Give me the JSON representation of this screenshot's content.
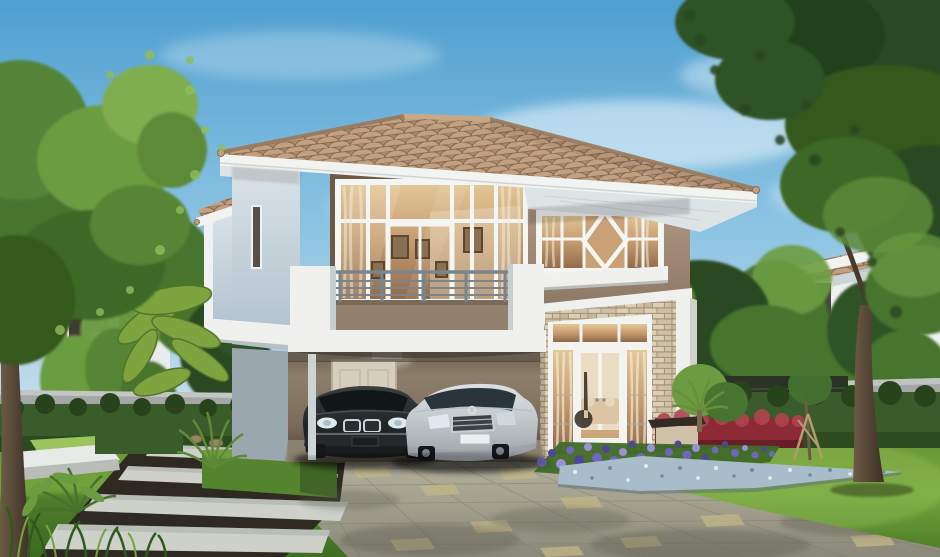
{
  "image": {
    "width": 940,
    "height": 557
  },
  "scene": {
    "title": "Exterior rendering of a two-storey detached house with carport, two sedans, front lawn and garden",
    "elements": [
      {
        "name": "sky",
        "label": "clear blue sky with wispy clouds"
      },
      {
        "name": "neighbor-house-left",
        "label": "neighbouring house behind trees, left"
      },
      {
        "name": "neighbor-house-right",
        "label": "neighbouring house behind trees, right"
      },
      {
        "name": "perimeter-wall",
        "label": "grey concrete garden wall"
      },
      {
        "name": "garden-fence",
        "label": "dark slatted fence"
      },
      {
        "name": "main-house",
        "label": "two-storey house, hip tiled roof, grey and taupe walls"
      },
      {
        "name": "main-roof",
        "label": "terracotta tiled hip roof with white fascia"
      },
      {
        "name": "upper-window",
        "label": "large upper-floor window wall with balcony doors"
      },
      {
        "name": "diamond-window",
        "label": "upper window band with diamond-shaped centre pane"
      },
      {
        "name": "balcony",
        "label": "balcony with metal railing and taupe parapet"
      },
      {
        "name": "carport",
        "label": "carport under the house with rear door and ceiling light"
      },
      {
        "name": "car-dark",
        "label": "dark grey sedan parked in carport"
      },
      {
        "name": "car-silver",
        "label": "silver sedan parked in carport"
      },
      {
        "name": "stone-wall",
        "label": "cream stacked-stone feature wall"
      },
      {
        "name": "french-doors",
        "label": "white french doors with sidelights, warm lit interior"
      },
      {
        "name": "driveway",
        "label": "paved driveway with pale accent tiles and dappled shade"
      },
      {
        "name": "stepping-stone-path",
        "label": "light concrete slab path over dark gravel"
      },
      {
        "name": "box-hedge",
        "label": "trimmed rectangular box hedge"
      },
      {
        "name": "red-hedge",
        "label": "clipped red-leaved hedge"
      },
      {
        "name": "flower-bed",
        "label": "purple flower bed"
      },
      {
        "name": "pebble-bed",
        "label": "blue-grey pebble mulch bed"
      },
      {
        "name": "garden-bench",
        "label": "small dark garden bench"
      },
      {
        "name": "staked-sapling",
        "label": "young staked tree"
      },
      {
        "name": "tree-left",
        "label": "light green foreground tree, left"
      },
      {
        "name": "tree-right",
        "label": "dark green foreground tree, right"
      },
      {
        "name": "banana-plant",
        "label": "banana-leaf plant beside house"
      },
      {
        "name": "lawn",
        "label": "green lawn"
      }
    ]
  },
  "palette": {
    "sky_top": "#4f9fd0",
    "sky_mid": "#8ec5e3",
    "sky_low": "#e7f1f5",
    "cloud": "#ffffff",
    "roof_tile": "#ad8b6e",
    "roof_tile_light": "#c2a183",
    "roof_tile_dark": "#7e5f47",
    "roof_ridge": "#9a795d",
    "fascia": "#f2f4f1",
    "soffit": "#dde4e6",
    "wall_light": "#ccd7df",
    "wall_light_shade": "#a9bac6",
    "trim_white": "#eff2f2",
    "wall_taupe": "#a38e7c",
    "bronze_trim": "#6e5947",
    "glass_warm": "#c59b6e",
    "curtain": "#f2ead9",
    "interior_cream": "#e9dcc2",
    "sofa": "#dcc5a3",
    "railing_metal": "#7b848b",
    "balcony_taupe": "#92816f",
    "slab_white": "#f0f1ee",
    "carport_wall": "#8d7d6c",
    "door_beige": "#d6cdbd",
    "stone_bg": "#a39176",
    "stone_a": "#dccfb8",
    "stone_b": "#cfc0a6",
    "stone_c": "#c6b69a",
    "car_dark": "#24282a",
    "chrome": "#cfd4d8",
    "headlight": "#dfe9ee",
    "car_silver": "#c2c8cc",
    "tire": "#141617",
    "car_glass": "#1e2a31",
    "lawn_mid": "#74a53c",
    "lawn_light": "#9cc45e",
    "lawn_dark": "#2e5a1e",
    "hedge": "#3a5c2a",
    "hedge_dark": "#27431c",
    "hedge_light": "#5d8a38",
    "box_hedge": "#55842f",
    "hedge_red": "#8e2a35",
    "hedge_red_light": "#b04350",
    "flower_purple": "#7166bd",
    "flower_purple_dark": "#4f4796",
    "flower_purple_light": "#9a91d8",
    "flower_leaf": "#3f6a26",
    "pebble": "#a9bcc9",
    "pebble_dark": "#72899b",
    "pebble_light": "#e6edf2",
    "drive_accent": "#c3b788",
    "drive_line": "#7e7c6a",
    "drive_shadow": "#55564a",
    "path_slab": "#cdd1ca",
    "path_gravel": "#2f2a21",
    "concrete": "#a3a8a6",
    "fence_dark": "#2b3226",
    "trunk": "#6e5b47",
    "trunk_dark": "#3c3025",
    "branch": "#5d4a36",
    "tree_dark": "#2a4a22",
    "tree_mid": "#47742f",
    "tree_light": "#6b9c41",
    "tree_bright": "#8fbe58",
    "banana": "#7da43f",
    "rock": "#9c8463",
    "bench_dark": "#332c25",
    "bench_base": "#cfc2a8"
  }
}
